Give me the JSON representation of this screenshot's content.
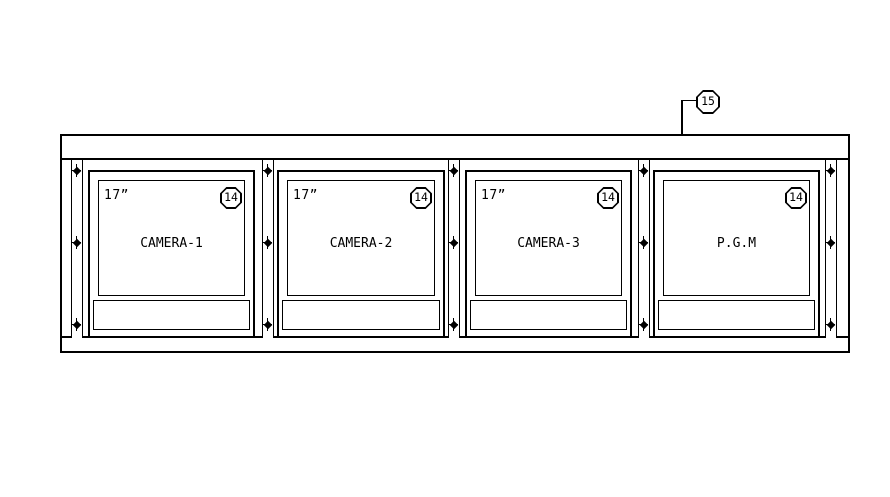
{
  "callout_top": {
    "number": "15"
  },
  "monitors": [
    {
      "size": "17”",
      "callout": "14",
      "label": "CAMERA-1"
    },
    {
      "size": "17”",
      "callout": "14",
      "label": "CAMERA-2"
    },
    {
      "size": "17”",
      "callout": "14",
      "label": "CAMERA-3"
    },
    {
      "callout": "14",
      "label": "P.G.M"
    }
  ],
  "colors": {
    "line": "#000000",
    "background": "#ffffff"
  }
}
